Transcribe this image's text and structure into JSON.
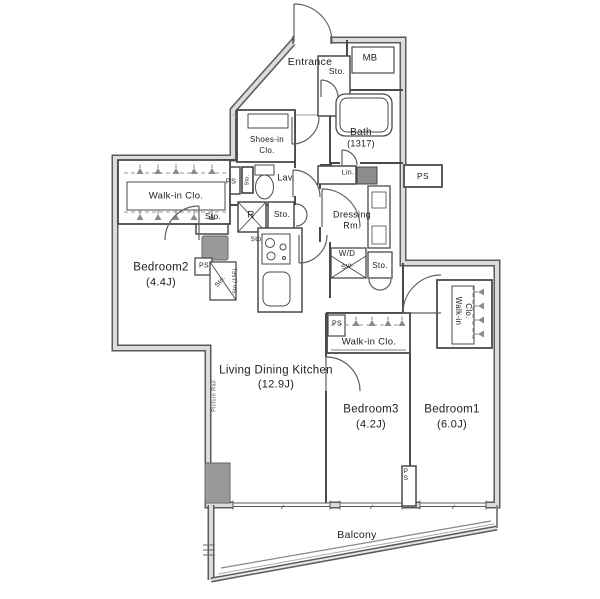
{
  "labels": {
    "entrance": "Entrance",
    "mb": "MB",
    "bath": "Bath",
    "bath_size": "(1317)",
    "shoes1": "Shoes-in",
    "shoes2": "Clo.",
    "lav": "Lav.",
    "lin": "Lin.",
    "dressing1": "Dressing",
    "dressing2": "Rm.",
    "wd": "W/D",
    "wd_sto": "Sto.",
    "ent_sto": "Sto.",
    "hall_sto": "Sto.",
    "drs_sto": "Sto.",
    "fridge": "R",
    "kitchen_sto": "Sto.",
    "b2_sto": "Sto.",
    "b2_sto_diag": "Sto.",
    "b2_sto_15f": "Sto.(15F)",
    "lav_sto": "Sto.",
    "ps_lav": "PS",
    "ps_b2": "PS",
    "ps_ext": "PS",
    "ps_wic3": "PS",
    "ps_balcony": "PS",
    "wic_b2": "Walk-in Clo.",
    "wic_b3": "Walk-in Clo.",
    "wic_b1a": "Walk-in",
    "wic_b1b": "Clo.",
    "bedroom2": "Bedroom2",
    "bedroom2_size": "(4.4J)",
    "bedroom3": "Bedroom3",
    "bedroom3_size": "(4.2J)",
    "bedroom1": "Bedroom1",
    "bedroom1_size": "(6.0J)",
    "ldk": "Living Dining Kitchen",
    "ldk_size": "(12.9J)",
    "balcony": "Balcony",
    "picture_rail": "Picture Rail"
  },
  "colors": {
    "wall_edge": "#5a5a5a",
    "wall_core": "#dcdcdc",
    "solid_fixture": "#9a9a9a"
  }
}
